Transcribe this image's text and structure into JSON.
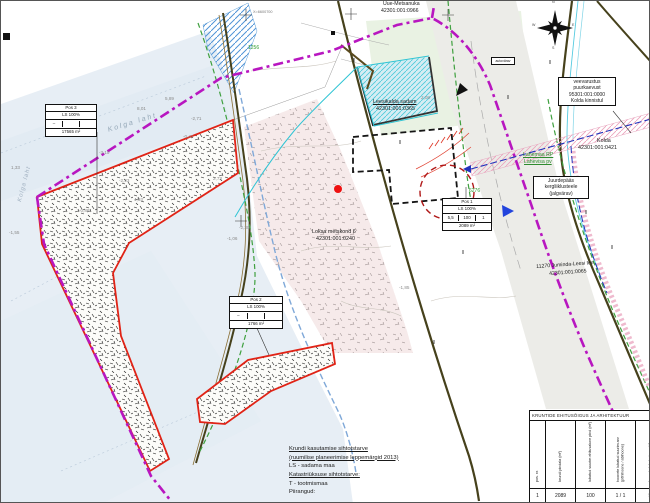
{
  "map_title": "Leesikalda sadama detailplaneering",
  "colors": {
    "boundary": "#b816c0",
    "plot_line": "#e02316",
    "water": "#e7eef5",
    "road": "#4a4016",
    "green_zone": "#3fa03f",
    "blue_dash": "#7fa8d8",
    "cyan": "#2fc4d4",
    "pink": "#eba4bd",
    "pipeline": "#2233bb"
  },
  "boxed_labels": {
    "autovarav": {
      "text": "autovärav"
    },
    "veevarustus": {
      "lines": [
        "veevarustus",
        "puurkaevust",
        "95301:001:0000",
        "Kolda kinnistul"
      ]
    },
    "juurdepaas": {
      "lines": [
        "Juurdepääs",
        "kergliiklusteele",
        "(jalgvärav)"
      ]
    }
  },
  "info_boxes": [
    {
      "x": 44,
      "y": 103,
      "w": 52,
      "pos": "Pos 3",
      "use": "LS 100%",
      "cells": [
        "–",
        "",
        ""
      ],
      "area": "17565 m²"
    },
    {
      "x": 228,
      "y": 295,
      "w": 54,
      "pos": "Pos 2",
      "use": "LS 100%",
      "cells": [
        "–",
        "",
        ""
      ],
      "area": "1766 m²"
    },
    {
      "x": 441,
      "y": 197,
      "w": 50,
      "pos": "Pos 1",
      "use": "LS 100%",
      "cells": [
        "5,5",
        "100",
        "1"
      ],
      "area": "2089 m²"
    }
  ],
  "ehitus_table": {
    "title": "KRUNTIDE EHITUSÕIGUS JA ARHITEKTUUR",
    "columns": [
      "pos. nr.",
      "krundi pindala (m²)",
      "lubatud suurim ehitusalune pind (m²)",
      "hoonete lubatud suurim arv (põhihoone / abihoone)",
      "hoonete lubatud max kõrgus maapinnast (m)"
    ],
    "rows": [
      [
        "1",
        "2089",
        "100",
        "1 / 1",
        "5,5"
      ],
      [
        "2",
        "1766",
        "–",
        "–",
        "–"
      ]
    ]
  },
  "legend": {
    "lines": [
      {
        "text": "Krundi kasutamise sihtotstarve",
        "u": 1
      },
      {
        "text": "(ruumilise planeerimise leppemärgid 2013)",
        "u": 1
      },
      {
        "text": "LS - sadama maa"
      },
      {
        "text": "Katastriüksuse sihtotstarve:",
        "u": 1
      },
      {
        "text": "T - tootmismaa"
      },
      {
        "text": " "
      },
      {
        "text": "Piirangud:"
      }
    ]
  },
  "map_labels": [
    {
      "t": "Uue-Metsanuka",
      "x": 382,
      "y": 1,
      "s": 5.2
    },
    {
      "t": "42301:001:0966",
      "x": 380,
      "y": 8,
      "s": 5.2
    },
    {
      "t": "Leesikalda sadam",
      "x": 372,
      "y": 99,
      "s": 5.4,
      "u": 1
    },
    {
      "t": "42301:001:0365",
      "x": 375,
      "y": 106,
      "s": 5.4
    },
    {
      "t": "Loksa metskond 6",
      "x": 311,
      "y": 229,
      "s": 5.4
    },
    {
      "t": "42301:001:0240",
      "x": 315,
      "y": 236,
      "s": 5.4
    },
    {
      "t": "Kolda",
      "x": 596,
      "y": 138,
      "s": 5.4
    },
    {
      "t": "42301:001:0421",
      "x": 577,
      "y": 145,
      "s": 5.4
    },
    {
      "t": "11270 Juminda-Leesi tee",
      "x": 535,
      "y": 264,
      "s": 5.2,
      "r": -4
    },
    {
      "t": "42301:001:0065",
      "x": 548,
      "y": 271,
      "s": 5.2,
      "r": -4
    },
    {
      "t": "Lahemaa RP",
      "x": 522,
      "y": 152,
      "s": 5.2,
      "c": "#2e8b2e",
      "u": 1
    },
    {
      "t": "Lahevisa pv",
      "x": 523,
      "y": 159,
      "s": 5.2,
      "c": "#2e8b2e",
      "u": 1
    },
    {
      "t": "1256",
      "x": 247,
      "y": 45,
      "s": 5,
      "c": "#2e9b2e"
    },
    {
      "t": "6276",
      "x": 468,
      "y": 188,
      "s": 5,
      "c": "#2e9b2e"
    },
    {
      "t": "0,78",
      "x": 565,
      "y": 184,
      "s": 5,
      "c": "#2e9b2e"
    },
    {
      "t": "Kolga laht",
      "x": 106,
      "y": 126,
      "s": 7,
      "c": "#93a6b6",
      "i": 1,
      "r": -17,
      "ls": 2
    },
    {
      "t": "Kolga laht",
      "x": 16,
      "y": 200,
      "s": 6,
      "c": "#a0b0c0",
      "i": 1,
      "r": -75,
      "ls": 1
    },
    {
      "t": "X=6600700",
      "x": 252,
      "y": 10,
      "s": 3.8,
      "c": "#777"
    },
    {
      "t": "-2,71",
      "x": 190,
      "y": 116,
      "s": 4.6,
      "c": "#8a8a8a"
    },
    {
      "t": "-3,10",
      "x": 98,
      "y": 150,
      "s": 4.6,
      "c": "#8a8a8a"
    },
    {
      "t": "-0,41",
      "x": 182,
      "y": 134,
      "s": 4.6,
      "c": "#8a8a8a"
    },
    {
      "t": "5,89",
      "x": 164,
      "y": 96,
      "s": 4.6,
      "c": "#8a8a8a"
    },
    {
      "t": "8,01",
      "x": 136,
      "y": 106,
      "s": 4.6,
      "c": "#8a8a8a"
    },
    {
      "t": "-2,23",
      "x": 118,
      "y": 178,
      "s": 4.6,
      "c": "#8a8a8a"
    },
    {
      "t": "2,73",
      "x": 212,
      "y": 176,
      "s": 4.6,
      "c": "#8a8a8a"
    },
    {
      "t": "-1,06",
      "x": 226,
      "y": 236,
      "s": 4.6,
      "c": "#8a8a8a"
    },
    {
      "t": "4,93",
      "x": 133,
      "y": 197,
      "s": 4.6,
      "c": "#8a8a8a"
    },
    {
      "t": "-2,30",
      "x": 238,
      "y": 225,
      "s": 4.6,
      "c": "#8a8a8a"
    },
    {
      "t": "-0,86",
      "x": 78,
      "y": 208,
      "s": 4.6,
      "c": "#8a8a8a"
    },
    {
      "t": "1,33",
      "x": 10,
      "y": 165,
      "s": 4.6,
      "c": "#8a8a8a"
    },
    {
      "t": "-1,55",
      "x": 8,
      "y": 230,
      "s": 4.6,
      "c": "#8a8a8a"
    },
    {
      "t": "-4,23",
      "x": 60,
      "y": 120,
      "s": 4.6,
      "c": "#8a8a8a"
    },
    {
      "t": "-1,85",
      "x": 398,
      "y": 285,
      "s": 4.6,
      "c": "#8a8a8a"
    },
    {
      "t": "2,08",
      "x": 420,
      "y": 95,
      "s": 4.6,
      "c": "#8a8a8a"
    },
    {
      "t": "‖",
      "x": 352,
      "y": 58,
      "s": 5,
      "c": "#222"
    },
    {
      "t": "‖",
      "x": 398,
      "y": 140,
      "s": 5,
      "c": "#222"
    },
    {
      "t": "‖",
      "x": 461,
      "y": 250,
      "s": 5,
      "c": "#222"
    },
    {
      "t": "‖",
      "x": 506,
      "y": 95,
      "s": 5,
      "c": "#222"
    },
    {
      "t": "‖",
      "x": 584,
      "y": 210,
      "s": 5,
      "c": "#222"
    },
    {
      "t": "‖",
      "x": 432,
      "y": 340,
      "s": 5,
      "c": "#222"
    },
    {
      "t": "‖",
      "x": 548,
      "y": 60,
      "s": 5,
      "c": "#222"
    },
    {
      "t": "‖",
      "x": 610,
      "y": 245,
      "s": 5,
      "c": "#222"
    },
    {
      "t": "N",
      "x": 551,
      "y": 0,
      "s": 3.6,
      "c": "#444"
    },
    {
      "t": "E",
      "x": 571,
      "y": 23,
      "s": 3.6,
      "c": "#444"
    },
    {
      "t": "S",
      "x": 551,
      "y": 46,
      "s": 3.6,
      "c": "#444"
    },
    {
      "t": "W",
      "x": 531,
      "y": 23,
      "s": 3.6,
      "c": "#444"
    }
  ]
}
